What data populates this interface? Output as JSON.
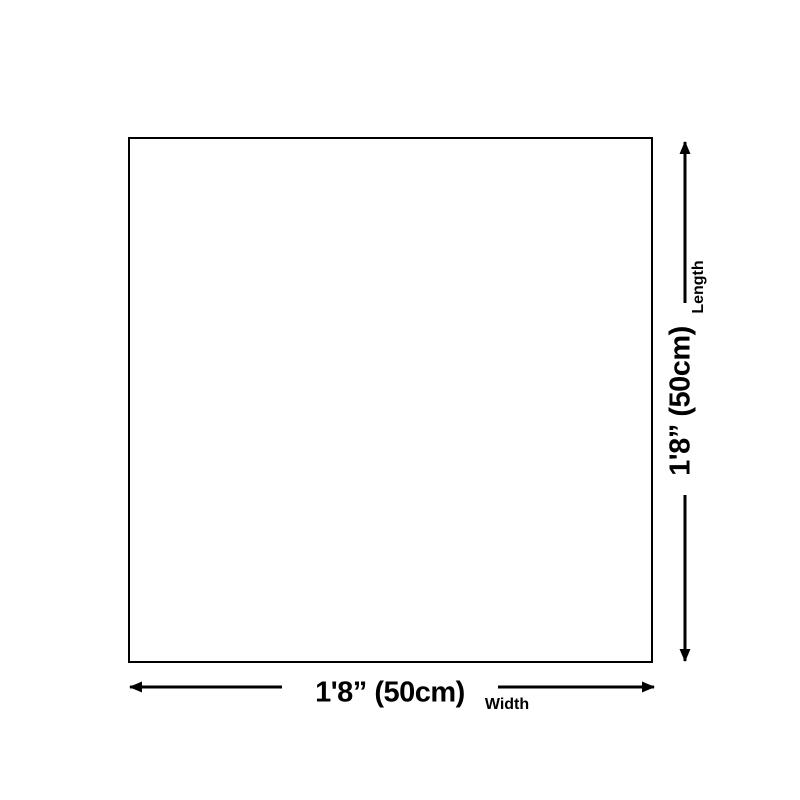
{
  "diagram": {
    "kind": "product-dimensions",
    "colors": {
      "background": "#ffffff",
      "line": "#000000",
      "text": "#000000"
    },
    "dimensions": {
      "length": {
        "value": "1'8” (50cm)",
        "label": "Length"
      },
      "width": {
        "value": "1'8” (50cm)",
        "label": "Width"
      }
    },
    "icons": {
      "arrowhead": "solid black triangle"
    }
  }
}
